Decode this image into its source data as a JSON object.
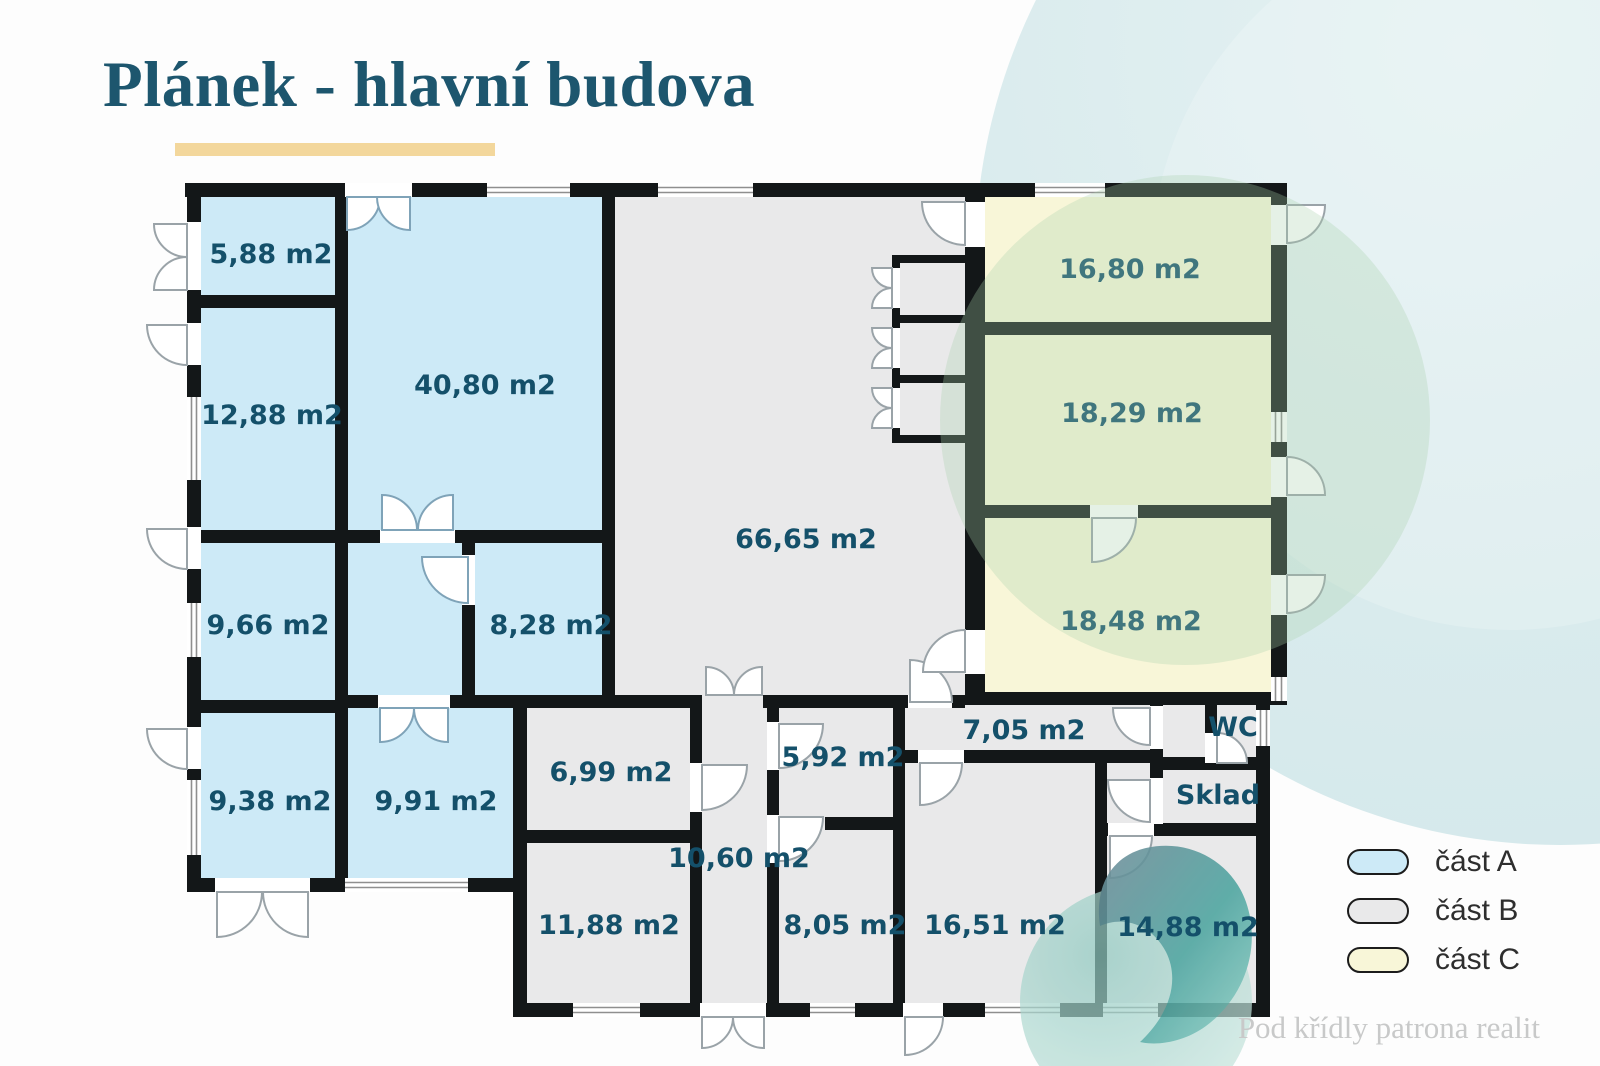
{
  "title": "Plánek - hlavní budova",
  "plan": {
    "rooms": [
      {
        "label": "5,88 m2",
        "part": "A"
      },
      {
        "label": "12,88 m2",
        "part": "A"
      },
      {
        "label": "40,80 m2",
        "part": "A"
      },
      {
        "label": "9,66 m2",
        "part": "A"
      },
      {
        "label": "8,28 m2",
        "part": "A"
      },
      {
        "label": "9,38 m2",
        "part": "A"
      },
      {
        "label": "9,91 m2",
        "part": "A"
      },
      {
        "label": "66,65 m2",
        "part": "B"
      },
      {
        "label": "6,99 m2",
        "part": "B"
      },
      {
        "label": "10,60 m2",
        "part": "B"
      },
      {
        "label": "11,88 m2",
        "part": "B"
      },
      {
        "label": "5,92 m2",
        "part": "B"
      },
      {
        "label": "8,05 m2",
        "part": "B"
      },
      {
        "label": "7,05 m2",
        "part": "B"
      },
      {
        "label": "16,51 m2",
        "part": "B"
      },
      {
        "label": "14,88 m2",
        "part": "B"
      },
      {
        "label": "16,80 m2",
        "part": "C"
      },
      {
        "label": "18,29 m2",
        "part": "C"
      },
      {
        "label": "18,48 m2",
        "part": "C"
      },
      {
        "label": "WC",
        "part": "B"
      },
      {
        "label": "Sklad",
        "part": "B"
      }
    ]
  },
  "legend": {
    "items": [
      {
        "label": "část A",
        "color": "#cdeaf7"
      },
      {
        "label": "část B",
        "color": "#e9e9ea"
      },
      {
        "label": "část C",
        "color": "#f8f6d8"
      }
    ]
  },
  "watermark": "Pod křídly patrona realit",
  "colors": {
    "wall": "#131718",
    "room_label": "#14506a",
    "part_a": "#cdeaf7",
    "part_b": "#e9e9ea",
    "part_c": "#f8f6d8",
    "title": "#1d566e",
    "underline": "#f3d79c"
  }
}
